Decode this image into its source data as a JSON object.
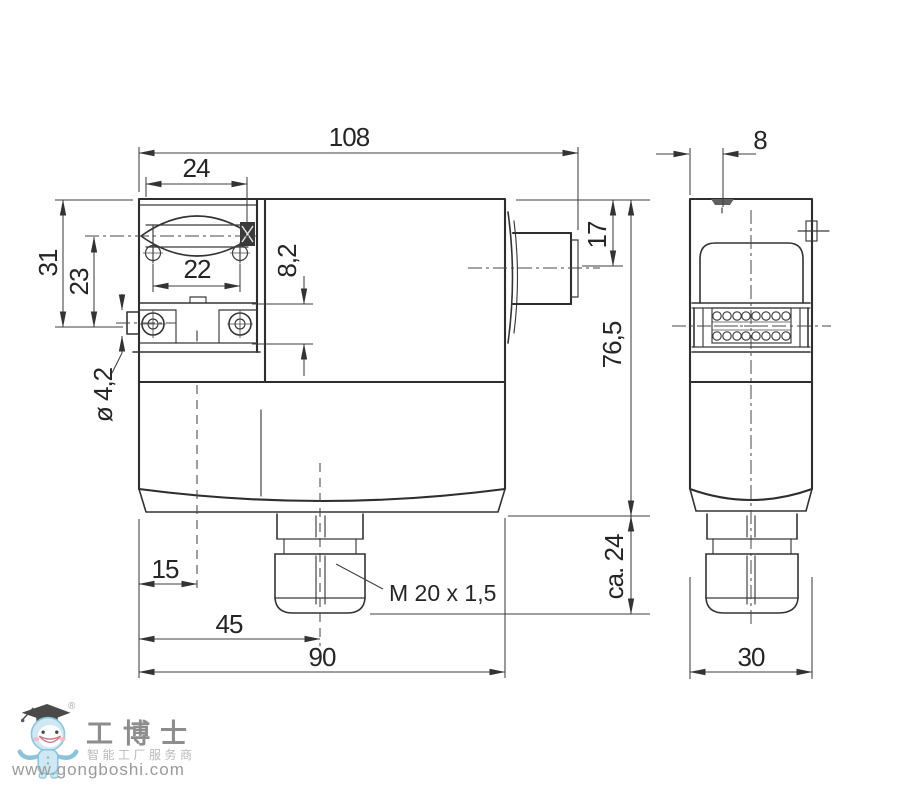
{
  "front_view": {
    "dim_total_width": "108",
    "dim_slot_width": "24",
    "dim_bracket_height": "31",
    "dim_bracket_mid_height": "23",
    "dim_screw_spacing": "22",
    "dim_plate_thickness": "8,2",
    "dim_hole_diameter": "ø 4,2",
    "dim_plug_offset": "17",
    "dim_body_height": "76,5",
    "dim_gland_height": "ca. 24",
    "dim_hole_edge_offset": "15",
    "dim_gland_center_offset": "45",
    "dim_body_width": "90",
    "label_thread": "M 20 x 1,5"
  },
  "side_view": {
    "dim_notch_width": "8",
    "dim_depth": "30"
  },
  "logo": {
    "registered": "®",
    "brand": "工博士",
    "tagline": "智能工厂服务商",
    "url": "www.gongboshi.com"
  }
}
